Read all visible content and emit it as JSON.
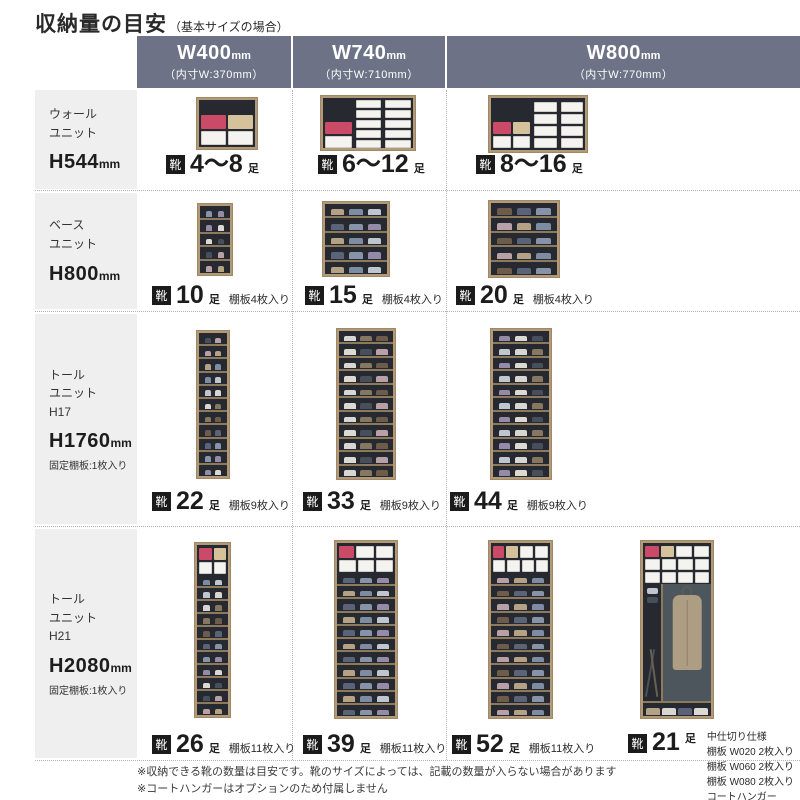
{
  "title": {
    "main": "収納量の目安",
    "sub": "（基本サイズの場合）"
  },
  "units": {
    "badge": "靴",
    "pairs": "足",
    "mm": "mm"
  },
  "columns": [
    {
      "size": "W400",
      "inner": "（内寸W:370mm）"
    },
    {
      "size": "W740",
      "inner": "（内寸W:710mm）"
    },
    {
      "size": "W800",
      "inner": "（内寸W:770mm）"
    }
  ],
  "rows": [
    {
      "label_lines": [
        "ウォール",
        "ユニット"
      ],
      "size": "H544",
      "note": "",
      "cells": [
        {
          "count": "4～8",
          "note": ""
        },
        {
          "count": "6～12",
          "note": ""
        },
        {
          "count": "8～16",
          "note": ""
        }
      ]
    },
    {
      "label_lines": [
        "ベース",
        "ユニット"
      ],
      "size": "H800",
      "note": "",
      "cells": [
        {
          "count": "10",
          "note": "棚板4枚入り"
        },
        {
          "count": "15",
          "note": "棚板4枚入り"
        },
        {
          "count": "20",
          "note": "棚板4枚入り"
        }
      ]
    },
    {
      "label_lines": [
        "トール",
        "ユニット",
        "H17"
      ],
      "size": "H1760",
      "note": "固定棚板:1枚入り",
      "cells": [
        {
          "count": "22",
          "note": "棚板9枚入り"
        },
        {
          "count": "33",
          "note": "棚板9枚入り"
        },
        {
          "count": "44",
          "note": "棚板9枚入り"
        }
      ]
    },
    {
      "label_lines": [
        "トール",
        "ユニット",
        "H21"
      ],
      "size": "H2080",
      "note": "固定棚板:1枚入り",
      "cells": [
        {
          "count": "26",
          "note": "棚板11枚入り"
        },
        {
          "count": "39",
          "note": "棚板11枚入り"
        },
        {
          "count": "52",
          "note": "棚板11枚入り"
        }
      ],
      "extra_cell": {
        "count": "21",
        "notes": [
          "中仕切り仕様",
          "棚板 W020 2枚入り",
          "棚板 W060 2枚入り",
          "棚板 W080 2枚入り",
          "コートハンガー"
        ]
      }
    }
  ],
  "footnotes": [
    "※収納できる靴の数量は目安です。靴のサイズによっては、記載の数量が入らない場合があります",
    "※コートハンガーはオプションのため付属しません"
  ],
  "colors": {
    "header_bg": "#6d7286",
    "sidebar_bg": "#efeff0",
    "accent_pink": "#cb4a67",
    "wood": "#b29977",
    "interior": "#262a30"
  }
}
